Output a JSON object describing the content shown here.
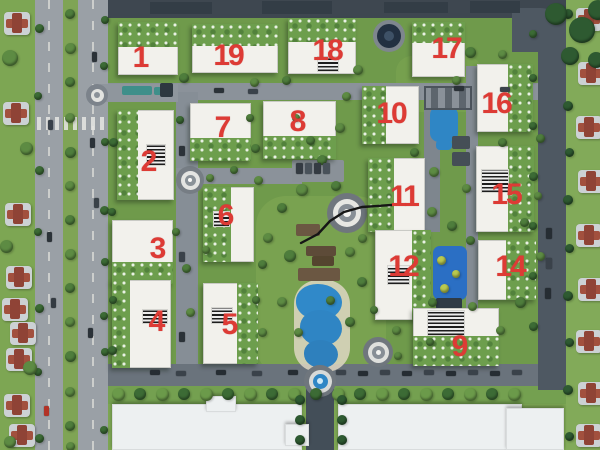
{
  "scene": {
    "kind": "aerial-3d-masterplan-render",
    "label_color": "#dd3b35"
  },
  "palette": {
    "lawn": "#7da653",
    "compound_lawn": "#6f9a4b",
    "roof_green": "#6d9e4d",
    "building_white": "#f2f1ec",
    "pool_blue": "#2f86c5",
    "road_gray": "#8f969d",
    "dark_road": "#47515b",
    "annotation_black": "#161616"
  },
  "building_labels": [
    {
      "number": "1",
      "x": 140,
      "y": 58
    },
    {
      "number": "19",
      "x": 228,
      "y": 56
    },
    {
      "number": "18",
      "x": 327,
      "y": 51
    },
    {
      "number": "17",
      "x": 446,
      "y": 49
    },
    {
      "number": "16",
      "x": 496,
      "y": 104
    },
    {
      "number": "7",
      "x": 222,
      "y": 128
    },
    {
      "number": "8",
      "x": 297,
      "y": 122
    },
    {
      "number": "10",
      "x": 391,
      "y": 114
    },
    {
      "number": "2",
      "x": 148,
      "y": 162
    },
    {
      "number": "11",
      "x": 404,
      "y": 197
    },
    {
      "number": "15",
      "x": 506,
      "y": 195
    },
    {
      "number": "6",
      "x": 225,
      "y": 216
    },
    {
      "number": "3",
      "x": 157,
      "y": 249
    },
    {
      "number": "12",
      "x": 403,
      "y": 267
    },
    {
      "number": "14",
      "x": 510,
      "y": 267
    },
    {
      "number": "4",
      "x": 156,
      "y": 322
    },
    {
      "number": "5",
      "x": 229,
      "y": 325
    },
    {
      "number": "9",
      "x": 459,
      "y": 347
    }
  ],
  "annotation_line": {
    "color": "#161616",
    "points": [
      [
        301,
        243
      ],
      [
        318,
        234
      ],
      [
        330,
        221
      ],
      [
        344,
        212
      ],
      [
        362,
        207
      ],
      [
        392,
        205
      ]
    ]
  }
}
